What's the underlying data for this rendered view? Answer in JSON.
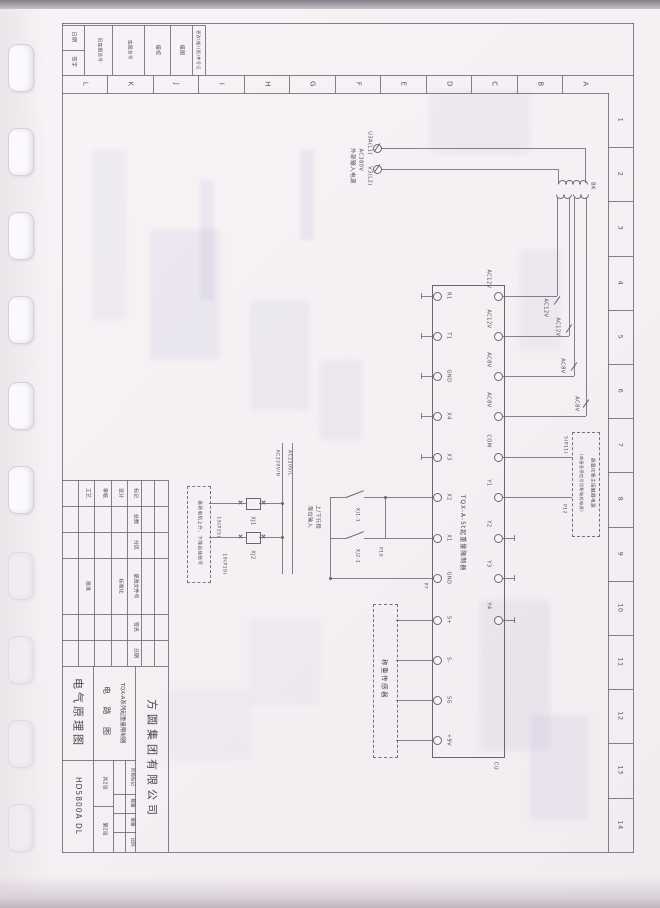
{
  "colors": {
    "paper": "#f5f0f3",
    "line": "#6b6573",
    "ink": "#4a4652",
    "ghost_blue": "#a09ecd"
  },
  "border": {
    "letters": [
      "L",
      "K",
      "J",
      "I",
      "H",
      "G",
      "F",
      "E",
      "D",
      "C",
      "B",
      "A"
    ],
    "numbers": [
      "1",
      "2",
      "3",
      "4",
      "5",
      "6",
      "7",
      "8",
      "9",
      "10",
      "11",
      "12",
      "13",
      "14"
    ]
  },
  "top_strip": {
    "date": "日期",
    "sign": "签字",
    "old_master_no": "旧底图总号",
    "master_no": "底图总号",
    "trace_check": "描校",
    "trace_draw": "描图",
    "change_record": "更改(幅)(图)件号记"
  },
  "schematic": {
    "input": {
      "phase1": "U3A(L1)",
      "phase2": "V3(L2)",
      "voltage": "AC380V",
      "caption": "外部输入电源"
    },
    "transformer": {
      "label": "BK"
    },
    "wires": {
      "ac12v_1": "AC12V",
      "ac12v_2": "AC12V",
      "ac8v_1": "AC8V",
      "ac8v_2": "AC8V",
      "line_l": "AC220V/L",
      "line_n": "AC220V/N",
      "p11": "5(P11)",
      "p12": "P12",
      "p10": "P10",
      "p7": "P7",
      "p15": "15(P15)",
      "p19": "19(P19)"
    },
    "controller": {
      "title": "TQX-A-5t起重量限制器",
      "corner": "CU",
      "left_terminals": [
        "R1",
        "T1",
        "GND",
        "X4",
        "X3",
        "X2",
        "X1",
        "GND",
        "S+",
        "S-",
        "SG",
        "+9V"
      ],
      "right_terminals": [
        "AC12V",
        "AC12V",
        "AC8V",
        "AC8V",
        "COM",
        "Y1",
        "Y2",
        "Y3",
        "Y4"
      ]
    },
    "relays": {
      "coil1": "XJ1",
      "coil2": "XJ2",
      "contact1": "XJ1-1",
      "contact2": "XJ2-1"
    },
    "limit_caption_line1": "上/下行程",
    "limit_caption_line2": "限位输入",
    "start_box_caption": "卷扬电机上升、下降启动信号",
    "overload_box_line1": "超载切断主接触器电源",
    "overload_box_line2": "(串接急停信号切断电机电源)",
    "load_cell_caption": "称重传感器"
  },
  "title_block": {
    "rev_header": [
      "标记",
      "处数",
      "分区",
      "更改文件号",
      "签名",
      "日期"
    ],
    "roles": {
      "design": "设计",
      "standard": "标准化",
      "review": "审核",
      "process": "工艺",
      "approve": "批准"
    },
    "stage": {
      "h1": "阶段标记",
      "h2": "数量",
      "h3": "重量",
      "h4": "比例"
    },
    "sheets": {
      "total": "共2张",
      "page": "第2张"
    },
    "company": "方圆集团有限公司",
    "product_line1": "TQX-A系列起重量限制器",
    "product_line2": "电 路 图",
    "doc_title": "电气原理图",
    "doc_no": "HD5800A DL"
  }
}
